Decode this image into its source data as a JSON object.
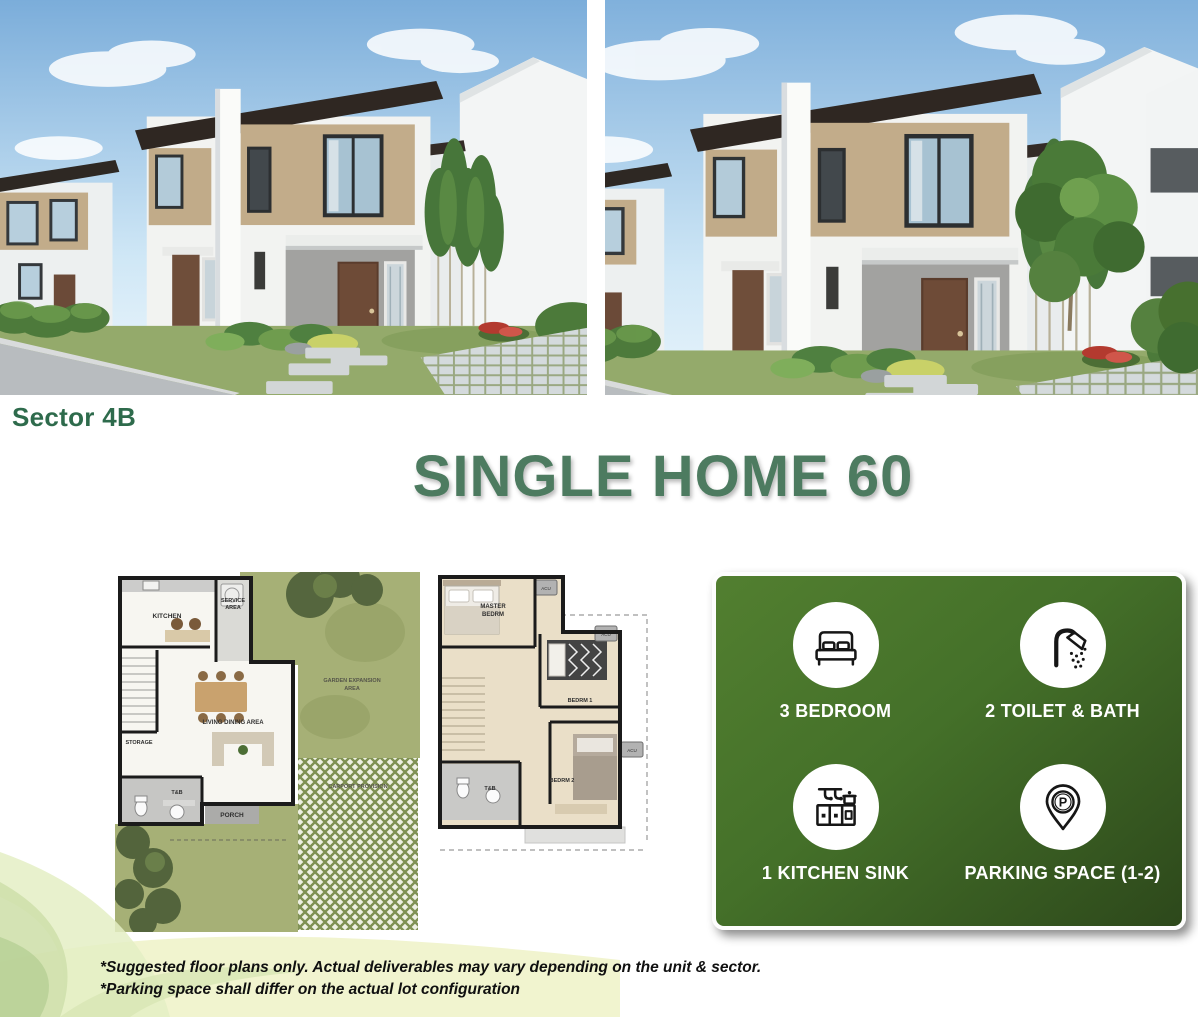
{
  "header": {
    "sector_label": "Sector 4B",
    "title": "SINGLE HOME 60"
  },
  "colors": {
    "sector_green": "#2e6b4c",
    "title_green": "#4d7b60",
    "panel_green_light": "#527f30",
    "panel_green_dark": "#2d481b"
  },
  "floor_plans": {
    "ground": {
      "kitchen": "KITCHEN",
      "service_line1": "SERVICE",
      "service_line2": "AREA",
      "storage": "STORAGE",
      "living_dining": "LIVING DINING AREA",
      "toilet_bath": "T&B",
      "porch": "PORCH",
      "garden_line1": "GARDEN EXPANSION",
      "garden_line2": "AREA",
      "carport": "CARPORT PROVISION"
    },
    "second": {
      "master_line1": "MASTER",
      "master_line2": "BEDRM",
      "bedroom1": "BEDRM 1",
      "bedroom2": "BEDRM 2",
      "toilet_bath": "T&B",
      "acu": "ACU"
    }
  },
  "features": {
    "items": [
      {
        "icon": "bed-icon",
        "label": "3 BEDROOM"
      },
      {
        "icon": "shower-icon",
        "label": "2 TOILET & BATH"
      },
      {
        "icon": "kitchen-sink-icon",
        "label": "1 KITCHEN SINK"
      },
      {
        "icon": "parking-pin-icon",
        "label": "PARKING SPACE (1-2)"
      }
    ]
  },
  "footnotes": {
    "line1": "*Suggested floor plans only. Actual deliverables may vary depending on the unit & sector.",
    "line2": "*Parking space shall differ on the actual lot configuration"
  }
}
